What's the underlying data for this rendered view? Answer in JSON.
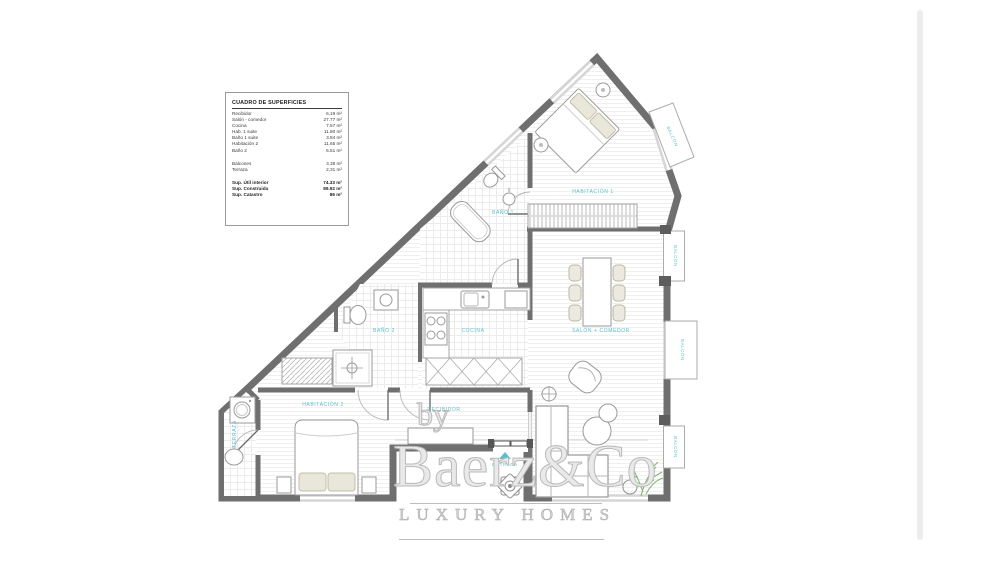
{
  "surface_table": {
    "title": "CUADRO DE SUPERFICIES",
    "rows": [
      {
        "label": "Recibidor",
        "value": "6.19 m²"
      },
      {
        "label": "Salón - comedor",
        "value": "27.77 m²"
      },
      {
        "label": "Cocina",
        "value": "7.57 m²"
      },
      {
        "label": "Hab. 1 suite",
        "value": "11.80 m²"
      },
      {
        "label": "Baño 1 suite",
        "value": "3.84 m²"
      },
      {
        "label": "Habitación 2",
        "value": "11.65 m²"
      },
      {
        "label": "Baño 2",
        "value": "5.51 m²"
      }
    ],
    "exterior_rows": [
      {
        "label": "Balcones",
        "value": "3,38 m²"
      },
      {
        "label": "Terraza",
        "value": "2,31 m²"
      }
    ],
    "total_rows": [
      {
        "label": "Sup. Útil interior",
        "value": "74.33 m²"
      },
      {
        "label": "Sup. Construida",
        "value": "89.92 m²"
      },
      {
        "label": "Sup. Catastro",
        "value": "86 m²"
      }
    ]
  },
  "rooms": {
    "hab1": "HABITACIÓN 1",
    "bano1": "BAÑO 1",
    "salon": "SALÓN + COMEDOR",
    "cocina": "COCINA",
    "bano2": "BAÑO 2",
    "hab2": "HABITACIÓN 2",
    "recibidor": "RECIBIDOR",
    "terraza": "TERRAZA",
    "entrada": "ENTRADA",
    "balcon": "BALCÓN"
  },
  "watermark": {
    "by": "by",
    "name": "Baerz&Co",
    "tagline": "LUXURY HOMES"
  },
  "colors": {
    "label_teal": "#5bc0cb",
    "wall_gray": "#6f6f6f",
    "watermark_gray": "#bdbdbd"
  }
}
